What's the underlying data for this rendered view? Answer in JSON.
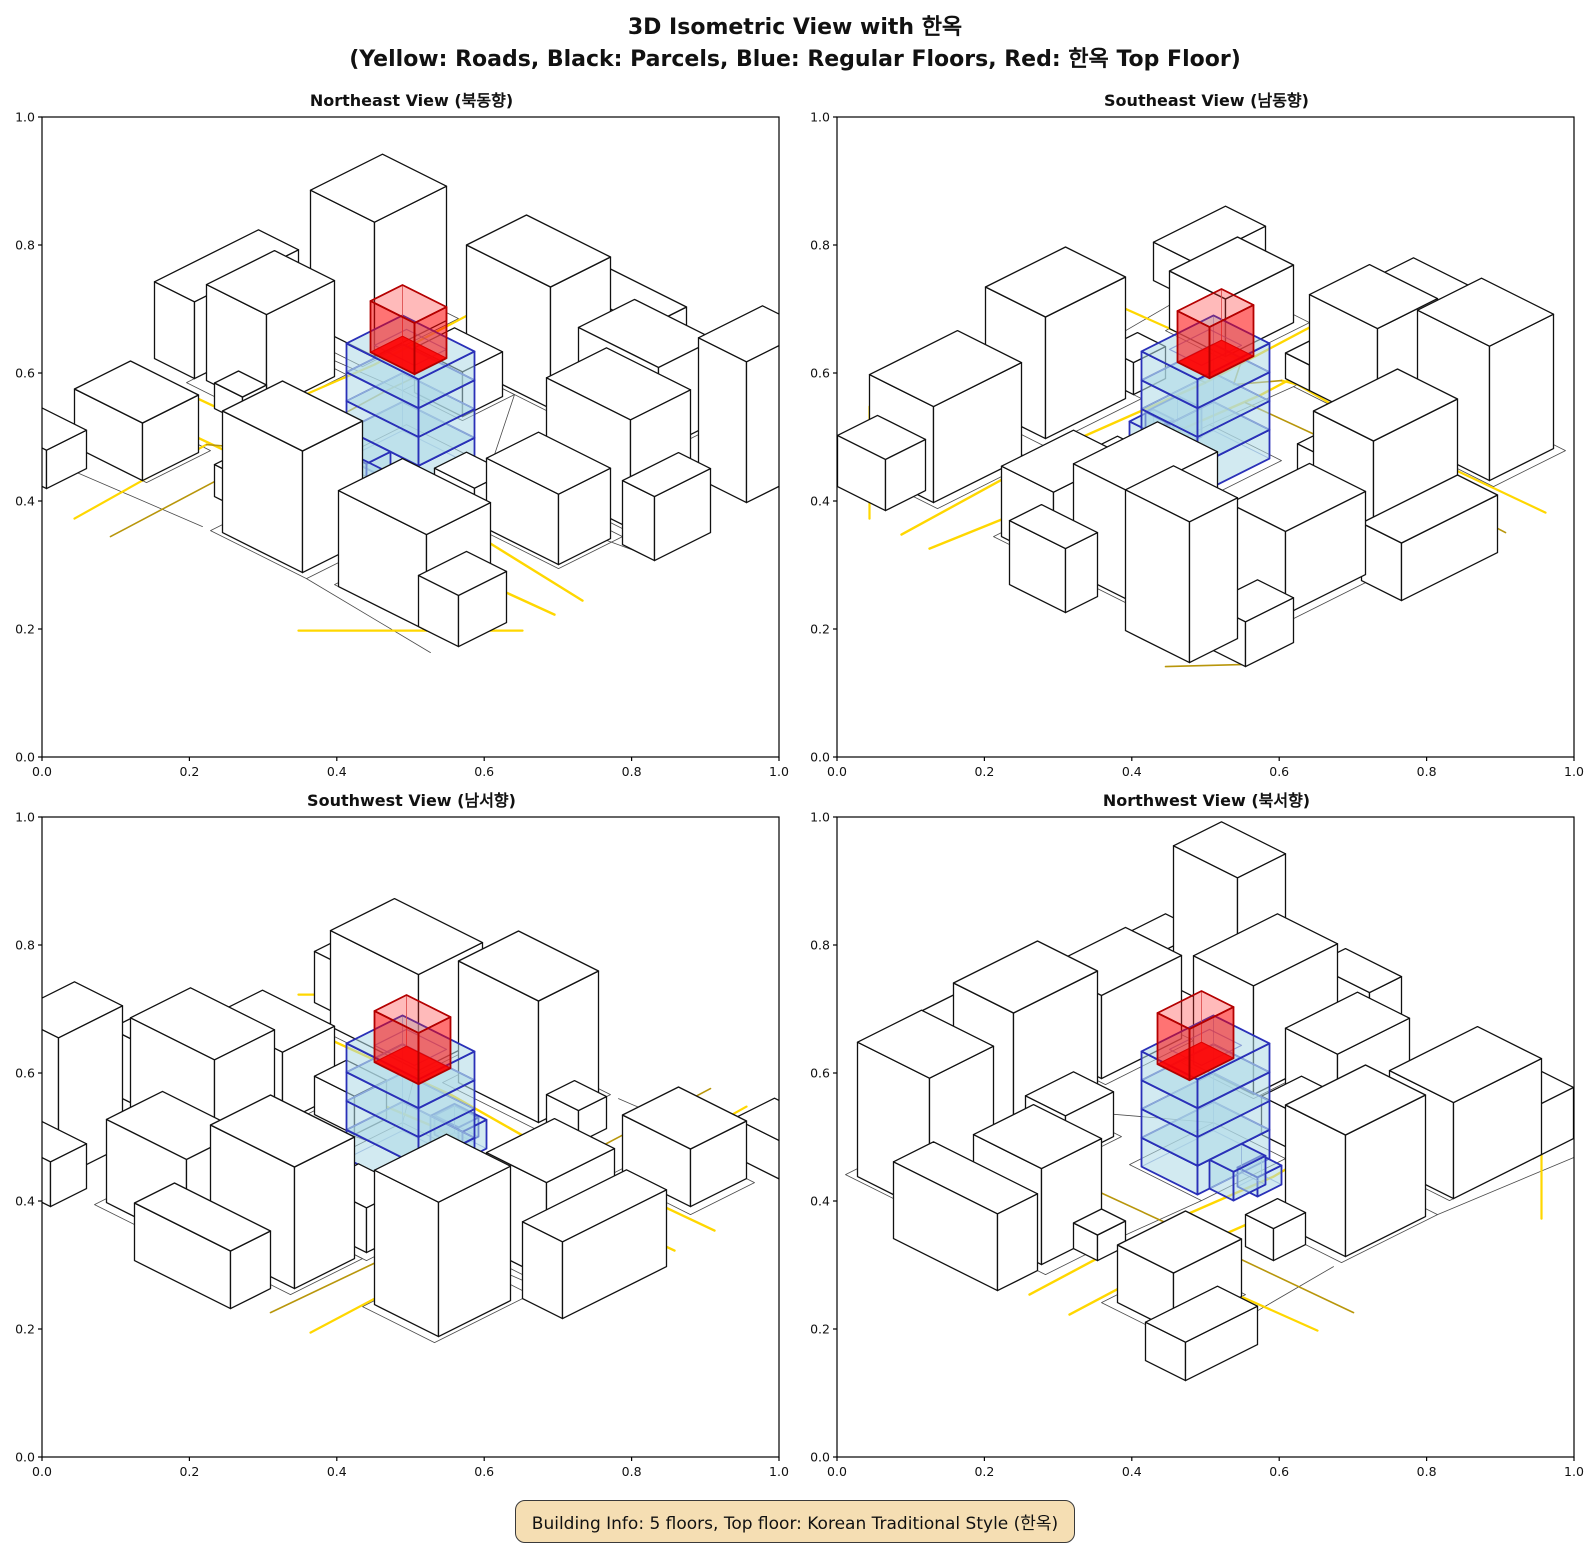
{
  "header": {
    "title_line1": "3D Isometric View with 한옥",
    "title_line2": "(Yellow: Roads, Black: Parcels, Blue: Regular Floors, Red: 한옥 Top Floor)"
  },
  "panels": [
    {
      "id": "northeast",
      "title": "Northeast View (북동향)",
      "rotation": 0
    },
    {
      "id": "southeast",
      "title": "Southeast View (남동향)",
      "rotation": 1
    },
    {
      "id": "southwest",
      "title": "Southwest View (남서향)",
      "rotation": 2
    },
    {
      "id": "northwest",
      "title": "Northwest View (북서향)",
      "rotation": 3
    }
  ],
  "axes": {
    "tick_values": [
      0,
      0.2,
      0.4,
      0.6,
      0.8,
      1.0
    ],
    "tick_labels": [
      "0.0",
      "0.2",
      "0.4",
      "0.6",
      "0.8",
      "1.0"
    ]
  },
  "footer": {
    "text": "Building Info: 5 floors, Top floor: Korean Traditional Style (한옥)",
    "bg": "#F5DEB3",
    "border": "#3a3a3a"
  },
  "colors": {
    "road_main": "#FFD700",
    "road_minor": "#B8960B",
    "parcel": "#4a4a4a",
    "building_edge": "#111111",
    "building_face": "#ffffff",
    "floor_fill": "rgba(173,216,230,0.55)",
    "floor_edge": "#2a30b8",
    "floor_back_edge": "rgba(122,143,208,0.8)",
    "hanok_side": "rgba(255,0,0,0.55)",
    "hanok_top": "rgba(255,40,40,0.32)",
    "hanok_inner": "rgba(255,0,0,0.85)",
    "hanok_edge": "#b40000",
    "hanok_back_edge": "rgba(205,95,95,0.65)",
    "frame": "#000000"
  },
  "chart_data": {
    "type": "3d-isometric-multiview",
    "figure_title": "3D Isometric View with 한옥",
    "figure_subtitle": "(Yellow: Roads, Black: Parcels, Blue: Regular Floors, Red: 한옥 Top Floor)",
    "views": [
      {
        "title": "Northeast View (북동향)"
      },
      {
        "title": "Southeast View (남동향)"
      },
      {
        "title": "Southwest View (남서향)"
      },
      {
        "title": "Northwest View (북서향)"
      }
    ],
    "axis": {
      "xlim": [
        0,
        1
      ],
      "ylim": [
        0,
        1
      ],
      "xticks": [
        0,
        0.2,
        0.4,
        0.6,
        0.8,
        1.0
      ],
      "yticks": [
        0,
        0.2,
        0.4,
        0.6,
        0.8,
        1.0
      ]
    },
    "legend": {
      "roads": "yellow",
      "parcels": "black",
      "regular_floors": "blue",
      "hanok_top_floor": "red"
    },
    "building": {
      "floors": 5,
      "regular_floors": 4,
      "top_floor": "Korean Traditional Style (한옥)"
    }
  },
  "scene": {
    "buildings": [
      {
        "x": 4,
        "y": 38,
        "w": 15,
        "d": 17,
        "h": 15
      },
      {
        "x": 3,
        "y": 10,
        "w": 16,
        "d": 18,
        "h": 21
      },
      {
        "x": 33,
        "y": 4,
        "w": 21,
        "d": 15,
        "h": 19
      },
      {
        "x": 58,
        "y": 2,
        "w": 20,
        "d": 14,
        "h": 13
      },
      {
        "x": 73,
        "y": 24,
        "w": 21,
        "d": 15,
        "h": 17
      },
      {
        "x": 76,
        "y": 44,
        "w": 18,
        "d": 13,
        "h": 11
      },
      {
        "x": 72,
        "y": 74,
        "w": 22,
        "d": 16,
        "h": 15
      },
      {
        "x": 44,
        "y": 76,
        "w": 20,
        "d": 15,
        "h": 19
      },
      {
        "x": 4,
        "y": 74,
        "w": 17,
        "d": 14,
        "h": 9
      },
      {
        "x": 33,
        "y": 22,
        "w": 12,
        "d": 10,
        "h": 7
      },
      {
        "x": 64,
        "y": 50,
        "w": 10,
        "d": 8,
        "h": 6
      },
      {
        "x": 90,
        "y": 2,
        "w": 12,
        "d": 16,
        "h": 22
      },
      {
        "x": 92,
        "y": 78,
        "w": 10,
        "d": 12,
        "h": 8
      },
      {
        "x": 12,
        "y": 55,
        "w": 7,
        "d": 6,
        "h": 4
      },
      {
        "x": 34,
        "y": 76,
        "w": 8,
        "d": 7,
        "h": 5
      },
      {
        "x": -8,
        "y": 30,
        "w": 10,
        "d": 26,
        "h": 12
      },
      {
        "x": 36,
        "y": -9,
        "w": 24,
        "d": 10,
        "h": 9
      },
      {
        "x": 84,
        "y": -6,
        "w": 12,
        "d": 9,
        "h": 7
      },
      {
        "x": 97,
        "y": 30,
        "w": 8,
        "d": 14,
        "h": 10
      },
      {
        "x": -7,
        "y": 92,
        "w": 18,
        "d": 10,
        "h": 6
      }
    ],
    "ground": [
      {
        "rect": [
          2,
          36,
          20,
          58
        ]
      },
      {
        "rect": [
          2,
          8,
          20,
          32
        ]
      },
      {
        "rect": [
          32,
          2,
          56,
          20
        ]
      },
      {
        "rect": [
          57,
          0,
          79,
          18
        ]
      },
      {
        "rect": [
          72,
          22,
          95,
          40
        ]
      },
      {
        "rect": [
          75,
          42,
          95,
          58
        ]
      },
      {
        "rect": [
          71,
          72,
          95,
          90
        ]
      },
      {
        "rect": [
          42,
          74,
          66,
          92
        ]
      },
      {
        "rect": [
          2,
          72,
          22,
          88
        ]
      },
      {
        "rect": [
          40,
          41,
          61,
          59
        ]
      },
      {
        "rect": [
          31,
          20,
          46,
          33
        ]
      },
      {
        "pts": [
          [
            0,
            35
          ],
          [
            31,
            33
          ]
        ]
      },
      {
        "pts": [
          [
            61,
            50
          ],
          [
            100,
            44
          ]
        ]
      },
      {
        "pts": [
          [
            46,
            20
          ],
          [
            61,
            41
          ]
        ]
      },
      {
        "pts": [
          [
            20,
            58
          ],
          [
            40,
            59
          ]
        ]
      },
      {
        "pts": [
          [
            61,
            59
          ],
          [
            71,
            72
          ]
        ]
      },
      {
        "pts": [
          [
            0,
            95
          ],
          [
            40,
            92
          ]
        ]
      },
      {
        "pts": [
          [
            66,
            92
          ],
          [
            100,
            95
          ]
        ]
      }
    ],
    "roads": [
      {
        "pts": [
          [
            -5,
            61
          ],
          [
            26,
            60
          ],
          [
            55,
            62
          ],
          [
            78,
            60
          ],
          [
            106,
            63
          ]
        ],
        "c": "main",
        "w": 2.4
      },
      {
        "pts": [
          [
            -5,
            71
          ],
          [
            30,
            70
          ],
          [
            62,
            72
          ],
          [
            106,
            70
          ]
        ],
        "c": "main",
        "w": 2.4
      },
      {
        "pts": [
          [
            20,
            -5
          ],
          [
            21,
            30
          ],
          [
            19,
            58
          ],
          [
            20,
            61
          ]
        ],
        "c": "main",
        "w": 2.2
      },
      {
        "pts": [
          [
            30,
            -5
          ],
          [
            29,
            35
          ],
          [
            30,
            60
          ]
        ],
        "c": "minor",
        "w": 1.6
      },
      {
        "pts": [
          [
            20,
            71
          ],
          [
            22,
            106
          ]
        ],
        "c": "main",
        "w": 2.2
      },
      {
        "pts": [
          [
            30,
            70
          ],
          [
            31,
            106
          ]
        ],
        "c": "minor",
        "w": 1.6
      },
      {
        "pts": [
          [
            20,
            61
          ],
          [
            27,
            66
          ],
          [
            20,
            71
          ]
        ],
        "c": "minor",
        "w": 1.6
      },
      {
        "pts": [
          [
            78,
            106
          ],
          [
            106,
            78
          ]
        ],
        "c": "main",
        "w": 2.2
      },
      {
        "pts": [
          [
            96,
            -5
          ],
          [
            106,
            4
          ]
        ],
        "c": "minor",
        "w": 1.6
      }
    ],
    "highlight": {
      "floors_rect": [
        41,
        43,
        59,
        57
      ],
      "floor_tops": [
        4.5,
        9,
        13.5,
        18
      ],
      "roof_inset": [
        45,
        46,
        55,
        54
      ],
      "red_rect": [
        43,
        45,
        54,
        53
      ],
      "red_z": [
        16,
        24
      ],
      "annex": [
        {
          "rect": [
            44,
            57,
            52,
            63
          ],
          "z": [
            0,
            4.5
          ]
        },
        {
          "rect": [
            48,
            60,
            54,
            65
          ],
          "z": [
            0,
            3
          ]
        }
      ]
    }
  }
}
